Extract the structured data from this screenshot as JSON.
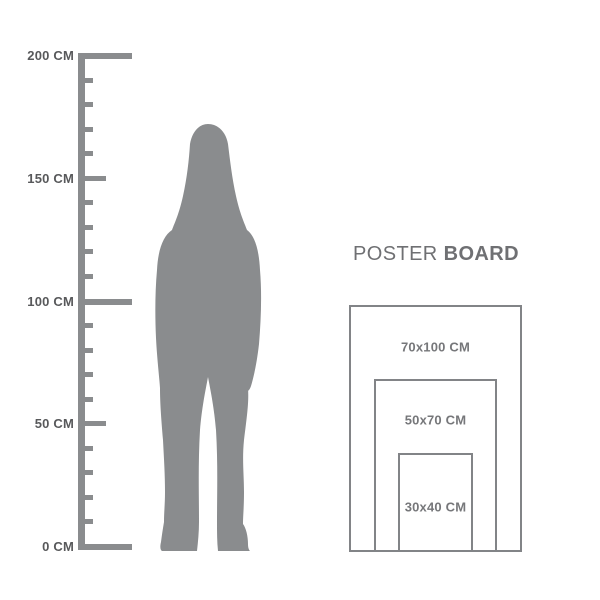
{
  "background": "#ffffff",
  "colors": {
    "figure": "#8A8C8E",
    "ruler": "#8A8C8E",
    "ruler_label": "#58595B",
    "title": "#6F7073",
    "box_border": "#828487",
    "box_label": "#76777A"
  },
  "ruler": {
    "unit": "CM",
    "min_cm": 0,
    "max_cm": 200,
    "tick_step_cm": 10,
    "labeled_ticks": [
      {
        "cm": 200,
        "label": "200 CM"
      },
      {
        "cm": 150,
        "label": "150 CM"
      },
      {
        "cm": 100,
        "label": "100 CM"
      },
      {
        "cm": 50,
        "label": "50 CM"
      },
      {
        "cm": 0,
        "label": "0 CM"
      }
    ]
  },
  "figure": {
    "name": "standing-woman-silhouette"
  },
  "poster_board": {
    "title_regular": "POSTER",
    "title_bold": "BOARD",
    "sizes": [
      {
        "label": "70x100 CM",
        "width_cm": 70,
        "height_cm": 100
      },
      {
        "label": "50x70 CM",
        "width_cm": 50,
        "height_cm": 70
      },
      {
        "label": "30x40 CM",
        "width_cm": 30,
        "height_cm": 40
      }
    ]
  }
}
